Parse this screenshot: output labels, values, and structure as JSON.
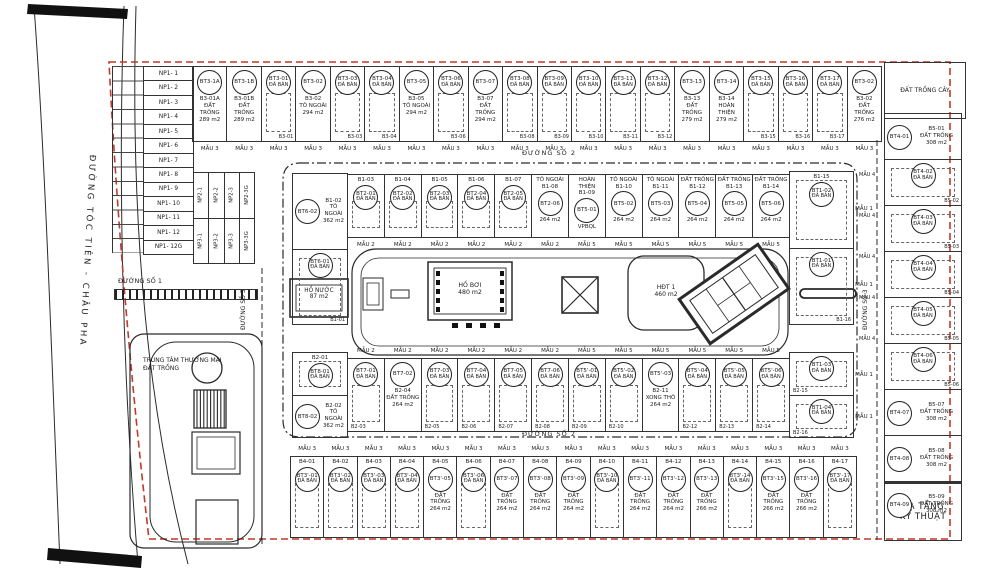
{
  "colors": {
    "line": "#2a2a2a",
    "boundary": "#c0392b",
    "ink": "#1c1c1c"
  },
  "roads": {
    "main_road": "ĐƯỜNG TÓC TIÊN - CHÂU PHA",
    "road1": "ĐƯỜNG SỐ 1",
    "road2_top": "ĐƯỜNG SỐ 2",
    "road2_bottom": "ĐƯỜNG SỐ 2",
    "road5": "ĐƯỜNG SỐ 5",
    "road3": "ĐƯỜNG SỐ 3"
  },
  "areas": {
    "pond": "HỒ NƯỚC\n87 m2",
    "pool": "HỒ BƠI\n480 m2",
    "hdt": "HĐT 1\n460 m2",
    "commercial": "TRUNG TÂM THƯƠNG MẠI\nĐẤT TRỐNG",
    "tree_area": "ĐẤT TRỒNG CÂY",
    "infrastructure": "HẠ TẦNG\nKỸ THUẬT"
  },
  "np1": {
    "rows": [
      "NP1- 1",
      "NP1- 2",
      "NP1- 3",
      "NP1- 4",
      "NP1- 5",
      "NP1- 6",
      "NP1- 7",
      "NP1- 8",
      "NP1- 9",
      "NP1- 10",
      "NP1- 11",
      "NP1- 12",
      "NP1- 12G"
    ]
  },
  "np2": [
    "NP2-1",
    "NP2-2",
    "NP2-3",
    "NP2-3G"
  ],
  "np3": [
    "NP3-1",
    "NP3-2",
    "NP3-3",
    "NP3-3G"
  ],
  "mau4_labels": [
    "MẪU 4",
    "MẪU 4",
    "MẪU 4",
    "MẪU 4",
    "MẪU 4"
  ],
  "lots": {
    "top_row": [
      {
        "bt": "BT3-1A",
        "bottom": "B3-01A\nĐẤT TRỐNG\n289 m2",
        "mau": "MẪU 3"
      },
      {
        "bt": "BT3-1B",
        "bottom": "B3-01B\nĐẤT TRỐNG\n289 m2",
        "mau": "MẪU 3"
      },
      {
        "bt": "BT3-01",
        "sold": "ĐÃ BÁN",
        "foot": "B3-01",
        "cls": "sold",
        "mau": "MẪU 3"
      },
      {
        "bt": "BT3-02",
        "bottom": "B3-02\nTÔ NGOÀI\n294 m2",
        "mau": "MẪU 3"
      },
      {
        "bt": "BT3-03",
        "sold": "ĐÃ BÁN",
        "foot": "B3-03",
        "cls": "sold",
        "mau": "MẪU 3"
      },
      {
        "bt": "BT3-04",
        "sold": "ĐÃ BÁN",
        "foot": "B3-04",
        "cls": "sold",
        "mau": "MẪU 3"
      },
      {
        "bt": "BT3-05",
        "bottom": "B3-05\nTÔ NGOÀI\n294 m2",
        "mau": "MẪU 3"
      },
      {
        "bt": "BT3-06",
        "sold": "ĐÃ BÁN",
        "foot": "B3-06",
        "cls": "sold",
        "mau": "MẪU 3"
      },
      {
        "bt": "BT3-07",
        "bottom": "B3-07\nĐẤT TRỐNG\n294 m2",
        "mau": "MẪU 3"
      },
      {
        "bt": "BT3-08",
        "sold": "ĐÃ BÁN",
        "foot": "B3-08",
        "cls": "sold",
        "mau": "MẪU 3"
      },
      {
        "bt": "BT3-09",
        "sold": "ĐÃ BÁN",
        "foot": "B3-09",
        "cls": "sold",
        "mau": "MẪU 3"
      },
      {
        "bt": "BT3-10",
        "sold": "ĐÃ BÁN",
        "foot": "B3-10",
        "cls": "sold",
        "mau": "MẪU 3"
      },
      {
        "bt": "BT3-11",
        "sold": "ĐÃ BÁN",
        "foot": "B3-11",
        "cls": "sold",
        "mau": "MẪU 3"
      },
      {
        "bt": "BT3-12",
        "sold": "ĐÃ BÁN",
        "foot": "B3-12",
        "cls": "sold",
        "mau": "MẪU 3"
      },
      {
        "bt": "BT3-13",
        "bottom": "B3-13\nĐẤT TRỐNG\n279 m2",
        "mau": "MẪU 3"
      },
      {
        "bt": "BT3-14",
        "bottom": "B3-14\nHOÀN THIỆN\n279 m2",
        "mau": "MẪU 3"
      },
      {
        "bt": "BT3-15",
        "sold": "ĐÃ BÁN",
        "foot": "B3-15",
        "cls": "sold",
        "mau": "MẪU 3"
      },
      {
        "bt": "BT3-16",
        "sold": "ĐÃ BÁN",
        "foot": "B3-16",
        "cls": "sold",
        "mau": "MẪU 3"
      },
      {
        "bt": "BT3-17",
        "sold": "ĐÃ BÁN",
        "foot": "B3-17",
        "cls": "sold",
        "mau": "MẪU 3"
      },
      {
        "bt": "BT3-02",
        "bottom": "B3-02\nĐẤT TRỐNG\n276 m2",
        "mau": "MẪU 3"
      }
    ],
    "inner_top_left": [
      {
        "bt": "BT6-02",
        "bottom": "B1-02\nTÔ NGOÀI\n362 m2",
        "cls": "hrow"
      },
      {
        "bt": "BT6-01",
        "sold": "ĐÃ BÁN",
        "foot": "B1-01",
        "cls": "sold"
      }
    ],
    "inner_top": [
      {
        "top": "B1-03",
        "bt": "BT2-01",
        "sold": "ĐÃ BÁN",
        "cls": "sold",
        "mau": "MẪU 2"
      },
      {
        "top": "B1-04",
        "bt": "BT2-02",
        "sold": "ĐÃ BÁN",
        "cls": "sold",
        "mau": "MẪU 2"
      },
      {
        "top": "B1-05",
        "bt": "BT2-03",
        "sold": "ĐÃ BÁN",
        "cls": "sold",
        "mau": "MẪU 2"
      },
      {
        "top": "B1-06",
        "bt": "BT2-04",
        "sold": "ĐÃ BÁN",
        "cls": "sold",
        "mau": "MẪU 2"
      },
      {
        "top": "B1-07",
        "bt": "BT2-05",
        "sold": "ĐÃ BÁN",
        "cls": "sold",
        "mau": "MẪU 2"
      },
      {
        "top": "TÔ NGOÀI\nB1-08",
        "bt": "BT2-06",
        "bottom": "264 m2",
        "mau": "MẪU 2"
      },
      {
        "top": "HOÀN THIỆN\nB1-09",
        "bt": "BT5-01",
        "bottom": "VPBQL",
        "mau": "MẪU 5"
      },
      {
        "top": "TÔ NGOÀI\nB1-10",
        "bt": "BT5-02",
        "bottom": "264 m2",
        "mau": "MẪU 5"
      },
      {
        "top": "TÔ NGOÀI\nB1-11",
        "bt": "BT5-03",
        "bottom": "264 m2",
        "mau": "MẪU 5"
      },
      {
        "top": "ĐẤT TRỐNG\nB1-12",
        "bt": "BT5-04",
        "bottom": "264 m2",
        "mau": "MẪU 5"
      },
      {
        "top": "ĐẤT TRỐNG\nB1-13",
        "bt": "BT5-05",
        "bottom": "264 m2",
        "mau": "MẪU 5"
      },
      {
        "top": "ĐẤT TRỐNG\nB1-14",
        "bt": "BT5-06",
        "bottom": "264 m2",
        "mau": "MẪU 5"
      }
    ],
    "inner_top_right": [
      {
        "top": "B1-15",
        "bt": "BT1-02",
        "sold": "ĐÃ BÁN",
        "cls": "sold",
        "mau": "MẪU 1"
      },
      {
        "bt": "BT1-01",
        "sold": "ĐÃ BÁN",
        "foot": "B1-16",
        "cls": "sold",
        "mau": "MẪU 1"
      }
    ],
    "inner_bottom_left": [
      {
        "top": "B2-01",
        "bt": "BT8-01",
        "sold": "ĐÃ BÁN",
        "cls": "sold"
      },
      {
        "bt": "BT8-02",
        "bottom": "B2-02\nTÔ NGOÀI\n362 m2",
        "cls": "hrow"
      }
    ],
    "inner_bottom": [
      {
        "bt": "BT7-01",
        "sold": "ĐÃ BÁN",
        "foot": "B2-03",
        "cls": "sold",
        "mau": "MẪU 2"
      },
      {
        "bt": "BT7-02",
        "bottom": "B2-04\nĐẤT TRỐNG\n264 m2",
        "mau": "MẪU 2"
      },
      {
        "bt": "BT7-03",
        "sold": "ĐÃ BÁN",
        "foot": "B2-05",
        "cls": "sold",
        "mau": "MẪU 2"
      },
      {
        "bt": "BT7-04",
        "sold": "ĐÃ BÁN",
        "foot": "B2-06",
        "cls": "sold",
        "mau": "MẪU 2"
      },
      {
        "bt": "BT7-05",
        "sold": "ĐÃ BÁN",
        "foot": "B2-07",
        "cls": "sold",
        "mau": "MẪU 2"
      },
      {
        "bt": "BT7-06",
        "sold": "ĐÃ BÁN",
        "foot": "B2-08",
        "cls": "sold",
        "mau": "MẪU 2"
      },
      {
        "bt": "BT5'-01",
        "sold": "ĐÃ BÁN",
        "foot": "B2-09",
        "cls": "sold",
        "mau": "MẪU 5"
      },
      {
        "bt": "BT5'-02",
        "sold": "ĐÃ BÁN",
        "foot": "B2-10",
        "cls": "sold",
        "mau": "MẪU 5"
      },
      {
        "bt": "BT5'-03",
        "bottom": "B2-11\nXONG THÔ\n264 m2",
        "mau": "MẪU 5"
      },
      {
        "bt": "BT5'-04",
        "sold": "ĐÃ BÁN",
        "foot": "B2-12",
        "cls": "sold",
        "mau": "MẪU 5"
      },
      {
        "bt": "BT5'-05",
        "sold": "ĐÃ BÁN",
        "foot": "B2-13",
        "cls": "sold",
        "mau": "MẪU 5"
      },
      {
        "bt": "BT5'-06",
        "sold": "ĐÃ BÁN",
        "foot": "B2-14",
        "cls": "sold",
        "mau": "MẪU 5"
      }
    ],
    "inner_bottom_right": [
      {
        "bt": "BT1-03",
        "sold": "ĐÃ BÁN",
        "foot": "B2-15",
        "cls": "sold",
        "mau": "MẪU 1"
      },
      {
        "bt": "BT1-04",
        "sold": "ĐÃ BÁN",
        "foot": "B2-16",
        "cls": "sold",
        "mau": "MẪU 1"
      }
    ],
    "bottom_row": [
      {
        "top": "B4-01",
        "bt": "BT3'-01",
        "sold": "ĐÃ BÁN",
        "cls": "sold",
        "mau": "MẪU 3"
      },
      {
        "top": "B4-02",
        "bt": "BT3'-02",
        "sold": "ĐÃ BÁN",
        "cls": "sold",
        "mau": "MẪU 3"
      },
      {
        "top": "B4-03",
        "bt": "BT3'-03",
        "sold": "ĐÃ BÁN",
        "cls": "sold",
        "mau": "MẪU 3"
      },
      {
        "top": "B4-04",
        "bt": "BT3'-04",
        "sold": "ĐÃ BÁN",
        "cls": "sold",
        "mau": "MẪU 3"
      },
      {
        "top": "B4-05",
        "bt": "BT3'-05",
        "bottom": "ĐẤT TRỐNG\n264 m2",
        "mau": "MẪU 3"
      },
      {
        "top": "B4-06",
        "bt": "BT3'-06",
        "sold": "ĐÃ BÁN",
        "cls": "sold",
        "mau": "MẪU 3"
      },
      {
        "top": "B4-07",
        "bt": "BT3'-07",
        "bottom": "ĐẤT TRỐNG\n264 m2",
        "mau": "MẪU 3"
      },
      {
        "top": "B4-08",
        "bt": "BT3'-08",
        "bottom": "ĐẤT TRỐNG\n264 m2",
        "mau": "MẪU 3"
      },
      {
        "top": "B4-09",
        "bt": "BT3'-09",
        "bottom": "ĐẤT TRỐNG\n264 m2",
        "mau": "MẪU 3"
      },
      {
        "top": "B4-10",
        "bt": "BT3'-10",
        "sold": "ĐÃ BÁN",
        "cls": "sold",
        "mau": "MẪU 3"
      },
      {
        "top": "B4-11",
        "bt": "BT3'-11",
        "bottom": "ĐẤT TRỐNG\n264 m2",
        "mau": "MẪU 3"
      },
      {
        "top": "B4-12",
        "bt": "BT3'-12",
        "bottom": "ĐẤT TRỐNG\n264 m2",
        "mau": "MẪU 3"
      },
      {
        "top": "B4-13",
        "bt": "BT3'-13",
        "bottom": "ĐẤT TRỐNG\n266 m2",
        "mau": "MẪU 3"
      },
      {
        "top": "B4-14",
        "bt": "BT3'-14",
        "sold": "ĐÃ BÁN",
        "cls": "sold",
        "mau": "MẪU 3"
      },
      {
        "top": "B4-15",
        "bt": "BT3'-15",
        "bottom": "ĐẤT TRỐNG\n266 m2",
        "mau": "MẪU 3"
      },
      {
        "top": "B4-16",
        "bt": "BT3'-16",
        "bottom": "ĐẤT TRỐNG\n266 m2",
        "mau": "MẪU 3"
      },
      {
        "top": "B4-17",
        "bt": "BT3'-17",
        "sold": "ĐÃ BÁN",
        "cls": "sold",
        "mau": "MẪU 3"
      }
    ],
    "right_col": [
      {
        "bt": "BT4-01",
        "bottom": "B5-01\nĐẤT TRỐNG\n308 m2",
        "cls": "hrow"
      },
      {
        "bt": "BT4-02",
        "sold": "ĐÃ BÁN",
        "foot": "B5-02",
        "cls": "sold"
      },
      {
        "bt": "BT4-03",
        "sold": "ĐÃ BÁN",
        "foot": "B5-03",
        "cls": "sold"
      },
      {
        "bt": "BT4-04",
        "sold": "ĐÃ BÁN",
        "foot": "B5-04",
        "cls": "sold"
      },
      {
        "bt": "BT4-05",
        "sold": "ĐÃ BÁN",
        "foot": "B5-05",
        "cls": "sold"
      },
      {
        "bt": "BT4-06",
        "sold": "ĐÃ BÁN",
        "foot": "B5-06",
        "cls": "sold"
      },
      {
        "bt": "BT4-07",
        "bottom": "B5-07\nĐẤT TRỐNG\n308 m2",
        "cls": "hrow"
      },
      {
        "bt": "BT4-08",
        "bottom": "B5-08\nĐẤT TRỐNG\n308 m2",
        "cls": "hrow"
      },
      {
        "bt": "BT4-09",
        "bottom": "B5-09\nĐẤT TRỐNG\n308 m2",
        "cls": "hrow"
      }
    ]
  }
}
